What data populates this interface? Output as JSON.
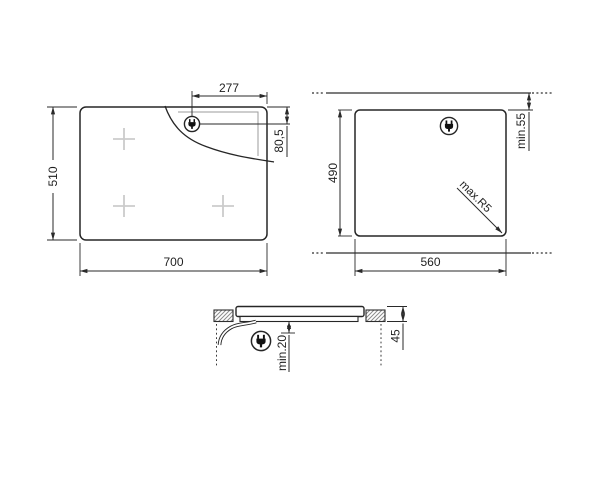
{
  "diagram": {
    "kind": "hob-installation-drawing",
    "colors": {
      "line": "#262626",
      "detail_line": "#9b9b9b",
      "burner_mark": "#cbcbcb",
      "background": "#ffffff"
    },
    "views": {
      "top": {
        "name": "hob top view",
        "width": "700",
        "depth": "510",
        "plug_offset_x": "277",
        "plug_offset_y": "80,5"
      },
      "cutout": {
        "name": "worktop cutout plan",
        "width": "560",
        "depth": "490",
        "rear_clearance": "min.55",
        "corner_radius": "max.R5"
      },
      "side": {
        "name": "side section view",
        "hob_height": "45",
        "bottom_clearance": "min.20"
      }
    },
    "icons": {
      "plug": "power-plug-icon"
    }
  }
}
